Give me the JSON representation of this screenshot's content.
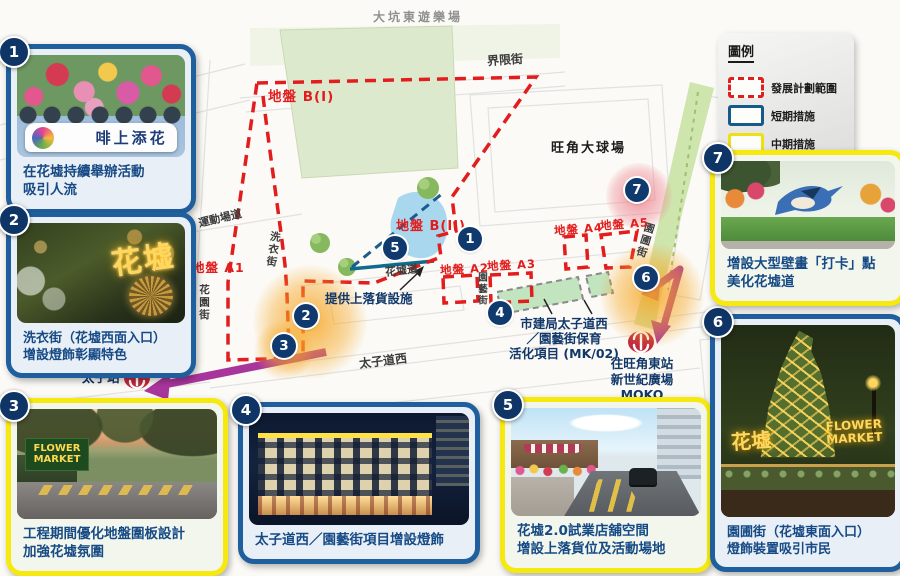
{
  "legend": {
    "title": "圖例",
    "items": [
      {
        "label": "發展計劃範圍",
        "swatch": "red-dashed",
        "color": "#e21d1d"
      },
      {
        "label": "短期措施",
        "swatch": "blue-solid",
        "color": "#155a8a"
      },
      {
        "label": "中期措施",
        "swatch": "yellow-solid",
        "color": "#eee012"
      }
    ]
  },
  "map": {
    "area_labels": {
      "playground": "大坑東遊樂場",
      "stadium": "旺角大球場"
    },
    "roads": {
      "boundary_street": "界限街",
      "playing_field_road": "運動場道",
      "sai_yee_street": "洗衣街",
      "fa_yuen_street": "花園街",
      "flower_market_road": "花墟道",
      "prince_edward_road_west": "太子道西",
      "yuen_ngai_street": "園藝街",
      "yuen_po_street": "園圃街"
    },
    "sites": {
      "b1": "地盤 B(I)",
      "b2": "地盤 B(II)",
      "a1": "地盤 A1",
      "a2": "地盤 A2",
      "a3": "地盤 A3",
      "a4": "地盤 A4",
      "a5": "地盤 A5"
    },
    "annotations": {
      "loading_facility": "提供上落貨設施",
      "urban_renewal_line1": "市建局太子道西",
      "urban_renewal_line2": "／園藝街保育",
      "urban_renewal_line3": "活化項目 (MK/02)",
      "prince_edward_station": "太子站",
      "mong_kok_east_line1": "往旺角東站",
      "mong_kok_east_line2": "新世紀廣場",
      "mong_kok_east_line3": "MOKO"
    },
    "markers": [
      "1",
      "2",
      "3",
      "4",
      "5",
      "6",
      "7"
    ]
  },
  "callouts": [
    {
      "num": "1",
      "type": "short-term",
      "lines": [
        "在花墟持續舉辦活動",
        "吸引人流"
      ],
      "photo_text": "啡上添花"
    },
    {
      "num": "2",
      "type": "short-term",
      "lines": [
        "洗衣街（花墟西面入口）",
        "增設燈飾彰顯特色"
      ],
      "photo_text": "花墟"
    },
    {
      "num": "3",
      "type": "mid-term",
      "lines": [
        "工程期間優化地盤圍板設計",
        "加強花墟氛圍"
      ],
      "photo_text": "FLOWER MARKET"
    },
    {
      "num": "4",
      "type": "short-term",
      "lines": [
        "太子道西／園藝街項目增設燈飾"
      ]
    },
    {
      "num": "5",
      "type": "mid-term",
      "lines": [
        "花墟2.0試業店舖空間",
        "增設上落貨位及活動場地"
      ]
    },
    {
      "num": "6",
      "type": "short-term",
      "lines": [
        "園圃街（花墟東面入口）",
        "燈飾裝置吸引市民"
      ],
      "photo_text": "花墟",
      "photo_text2": "FLOWER MARKET"
    },
    {
      "num": "7",
      "type": "mid-term",
      "lines": [
        "增設大型壁畫「打卡」點",
        "美化花墟道"
      ]
    }
  ],
  "colors": {
    "plan_boundary_red": "#e21d1d",
    "short_term_blue": "#1f5f9e",
    "mid_term_yellow": "#f6e90f",
    "marker_navy": "#103a6d",
    "arrow_purple": "#a8359c",
    "mtr_red": "#c22a3c"
  }
}
